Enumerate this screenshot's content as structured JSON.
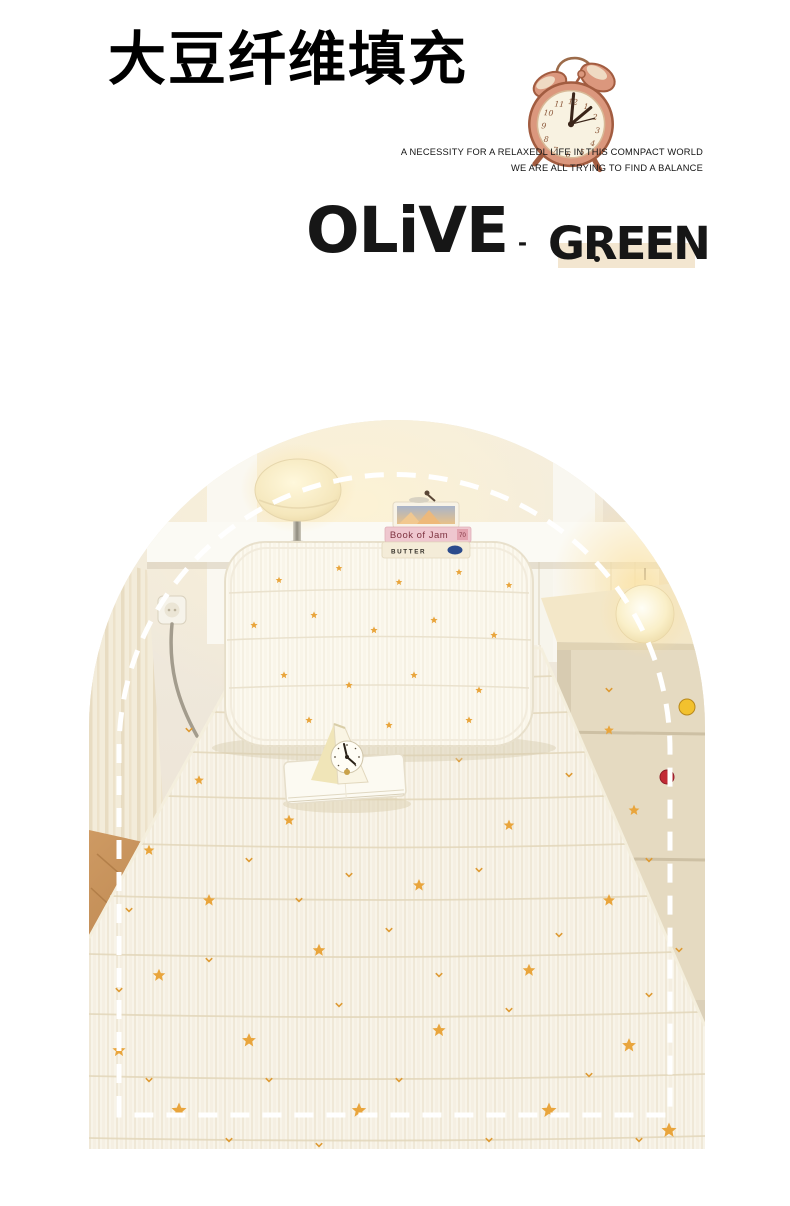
{
  "page": {
    "background": "#FFFFFF"
  },
  "header": {
    "title": "大豆纤维填充",
    "tagline_line1": "A NECESSITY FOR A RELAXEDL LIFE IN THIS COMNPACT WORLD",
    "tagline_line2": "WE ARE ALL TRYING TO FIND A BALANCE"
  },
  "brand": {
    "primary": "OLiVE",
    "separator": "-",
    "secondary": "GREEN",
    "highlight_color": "#F3E6D0",
    "text_color": "#161616"
  },
  "clock_illustration": {
    "body_color": "#DB977D",
    "face_color": "#F8F2E1",
    "face_numbers": [
      "12",
      "1",
      "2",
      "3",
      "4",
      "5",
      "6",
      "7",
      "8",
      "9",
      "10",
      "11"
    ]
  },
  "photo": {
    "shelf_books": {
      "book1_title": "Book of Jam",
      "book1_label": "70",
      "book2_title": "BUTTER"
    },
    "star_color": "#E9A53C",
    "dashed_outline_color": "#FFFFFF",
    "nightstand_knob_colors": [
      "#F2C12E",
      "#C22A35"
    ]
  }
}
